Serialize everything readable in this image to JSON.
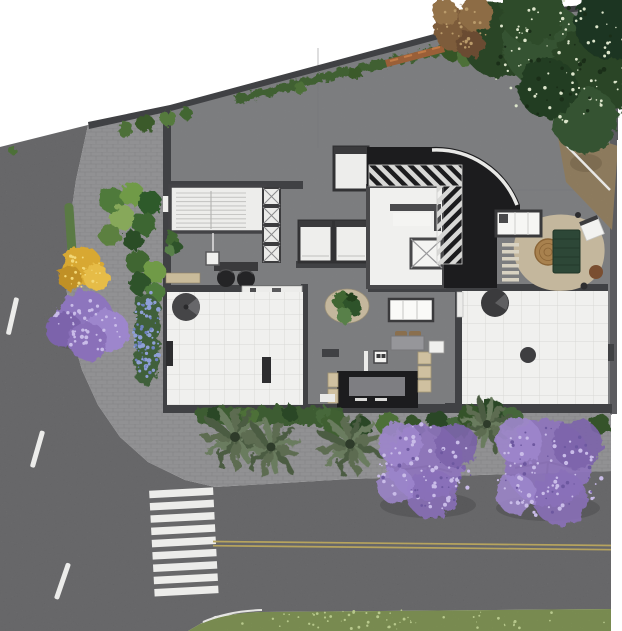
{
  "meta": {
    "scene_type": "aerial architectural site-plan rendering",
    "contains_text": false
  },
  "palette": {
    "canvas": "#ffffff",
    "asphalt": "#6d6d6f",
    "paver": "#a6a6a8",
    "concrete": "#8b8c8e",
    "wall": "#404144",
    "room_white": "#f0f0ee",
    "ramp_black": "#1c1c1e",
    "hazard_light": "#d8d8d6",
    "curb_white": "#e8e8e6",
    "lane_white": "#ececea",
    "center_yellow": "#b7a45e",
    "grass": "#93aa62",
    "dirt": "#ac9672",
    "tree_green_dark": "#2c4527",
    "tree_green": "#3a5a31",
    "hedge": "#3d5c33",
    "shrub_bright": "#6f9a46",
    "palm": "#5d6c51",
    "jacaranda": "#9a81c6",
    "jacaranda_light": "#b3a0dd",
    "flower_blue": "#8495cd",
    "tree_yellow": "#d9ab32",
    "tree_brown": "#7d5c3a",
    "rug": "#c4b79d",
    "sofa_green": "#2d4737",
    "wood": "#a8814e",
    "stool": "#cfc0a0",
    "bench_wood": "#c9bb9a",
    "chair_brown": "#8a6f4e"
  },
  "scene": {
    "streets": {
      "layout": "left street curving into bottom street",
      "lane_dashes": 3,
      "crosswalk_stripes": 9,
      "center_line": "double yellow"
    },
    "building": {
      "rooms": [
        "stairwell",
        "shaft-column",
        "elevator",
        "elevator-bank",
        "lobby-hall",
        "service-shaft",
        "driveway-ramp",
        "lounge",
        "reception",
        "left-terrace",
        "bar-kitchen",
        "right-terrace"
      ],
      "furniture": [
        "reception-chairs",
        "wood-bench",
        "credenza",
        "fire-table",
        "terrace-benches",
        "kitchenette",
        "slat-lounger",
        "round-coffee-table",
        "green-sofa",
        "lounge-chair",
        "planters",
        "bar-counter",
        "bar-stools",
        "dining-set"
      ]
    },
    "vegetation": {
      "jacaranda_trees": 3,
      "yellow_tree": 1,
      "palm_trees": 4,
      "corner_canopy": "dense dark green with white blossoms",
      "flower_bed": "blue violet",
      "wall_vine": true,
      "hedges": true
    },
    "ground": {
      "sidewalk": "paver blocks",
      "site": "concrete slab",
      "bottom_strip": "lawn",
      "top_right": "bare dirt under trees"
    }
  }
}
